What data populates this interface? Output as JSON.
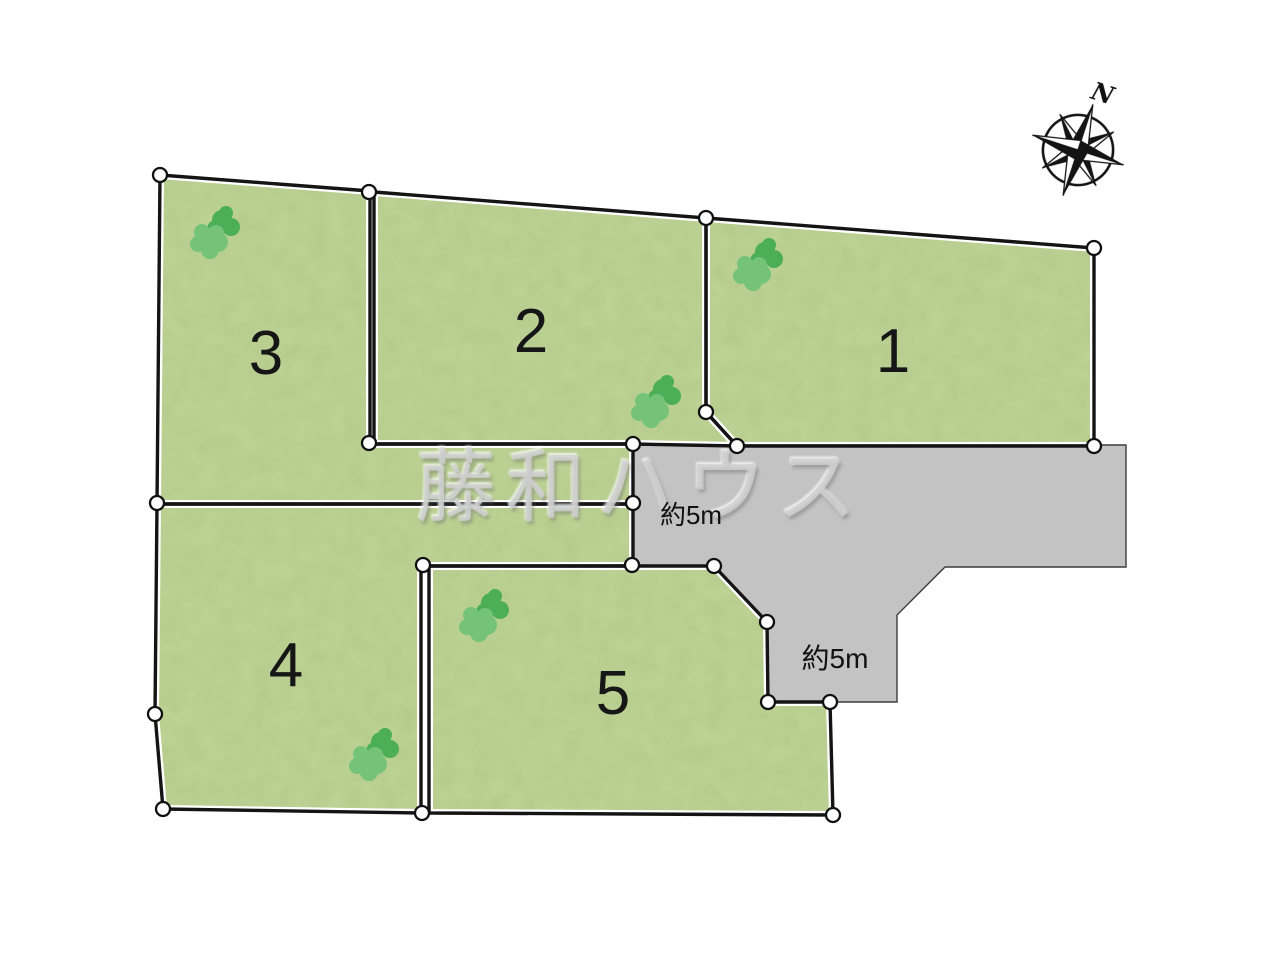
{
  "diagram": {
    "watermark": "藤和ハウス",
    "compass_label": "N",
    "lots": [
      {
        "number": "1"
      },
      {
        "number": "2"
      },
      {
        "number": "3"
      },
      {
        "number": "4"
      },
      {
        "number": "5"
      }
    ],
    "road_labels": [
      {
        "text": "約5m"
      },
      {
        "text": "約5m"
      }
    ],
    "colors": {
      "lot_green": "#bcd294",
      "road_gray": "#c3c3c3",
      "boundary": "#141414",
      "tree_dark": "#4cae57",
      "tree_light": "#74c379",
      "background": "#ffffff"
    }
  }
}
